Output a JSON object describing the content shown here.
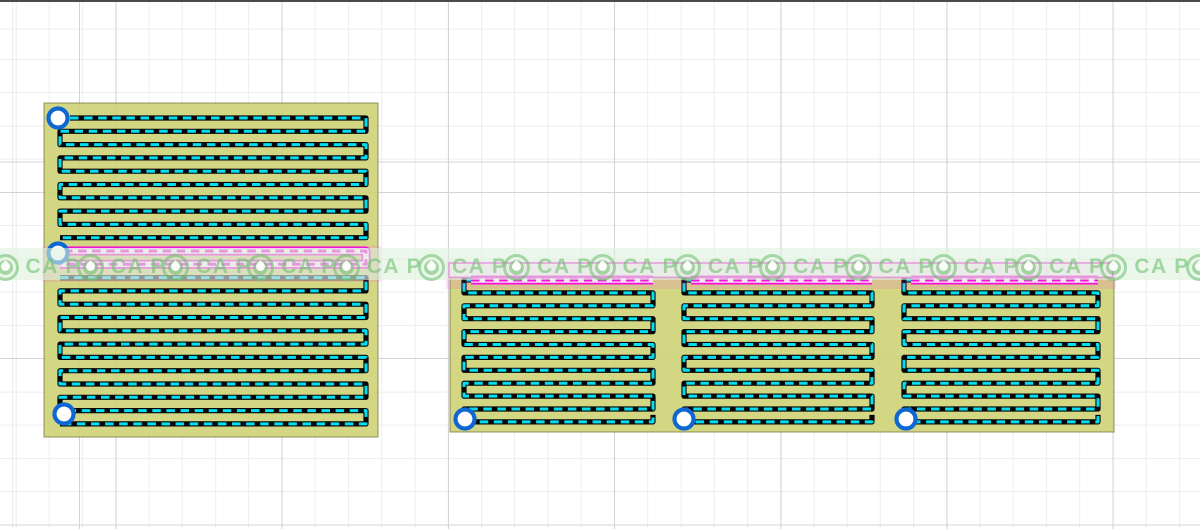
{
  "canvas": {
    "width": 1200,
    "height": 529,
    "background": "#ffffff",
    "top_border_color": "#4a4a4a",
    "grid": {
      "minor_step": 33.24,
      "major_step": 166.2,
      "minor_color": "#ededed",
      "major_color": "#d4d4d4",
      "offset_x": 15.7,
      "offset_y": 29.6,
      "major_offset_x": 115.5,
      "major_offset_y": 162.5
    }
  },
  "colors": {
    "board_fill": "rgba(206,210,118,0.9)",
    "board_edge": "rgba(110,110,60,0.6)",
    "trace": "#060606",
    "trace_dash": "#00def2",
    "selected": "#f410dc",
    "selected_dash": "#fde8fb",
    "halo": "rgba(240,80,215,0.16)",
    "pad_ring": "#0e67d2",
    "pad_fill": "#ffffff"
  },
  "trace_style": {
    "base_width": 5.2,
    "dash_width": 3,
    "dash": "8.5 5.6",
    "sel_base_width": 9,
    "sel_mid_width": 5.5,
    "sel_dash_width": 3
  },
  "boards": [
    {
      "name": "left-board",
      "x": 44,
      "y": 103,
      "w": 334,
      "h": 334,
      "serpentine": {
        "xL": 60,
        "xR": 366,
        "y0": 118,
        "dy": 13.3,
        "rows": 24,
        "start_x": 70,
        "selected_rows": [
          10,
          11
        ],
        "sel_start_x": 64
      },
      "pads": [
        {
          "cx": 58,
          "cy": 118
        },
        {
          "cx": 58,
          "cy": 253
        },
        {
          "cx": 64,
          "cy": 414
        }
      ],
      "halo": {
        "x": 42,
        "y": 246,
        "w": 339,
        "h": 36
      }
    },
    {
      "name": "right-board",
      "x": 450,
      "y": 277,
      "w": 664,
      "h": 155,
      "row_y0": 280,
      "row_dy": 12.9,
      "rows": 12,
      "pad_y": 419,
      "sections": [
        {
          "xL": 457,
          "xR": 660,
          "pad_x": 465
        },
        {
          "xL": 677,
          "xR": 879,
          "pad_x": 684
        },
        {
          "xL": 897,
          "xR": 1105,
          "pad_x": 906
        }
      ],
      "halo": {
        "x": 446,
        "y": 261,
        "w": 670,
        "h": 28
      },
      "selection_outline": {
        "x": 449,
        "y": 263,
        "w": 663.5,
        "h": 14.5
      }
    }
  ],
  "watermark": {
    "label": "CA P",
    "count": 15,
    "first_circle_cx": 5,
    "step": 85.3,
    "circle_cy": 267,
    "circle_d": 27,
    "text_color": "rgba(110,192,110,0.6)",
    "circle_color": "rgba(106,190,106,0.55)",
    "band": {
      "y": 248,
      "h": 32,
      "color": "rgba(222,242,222,0.6)"
    }
  }
}
